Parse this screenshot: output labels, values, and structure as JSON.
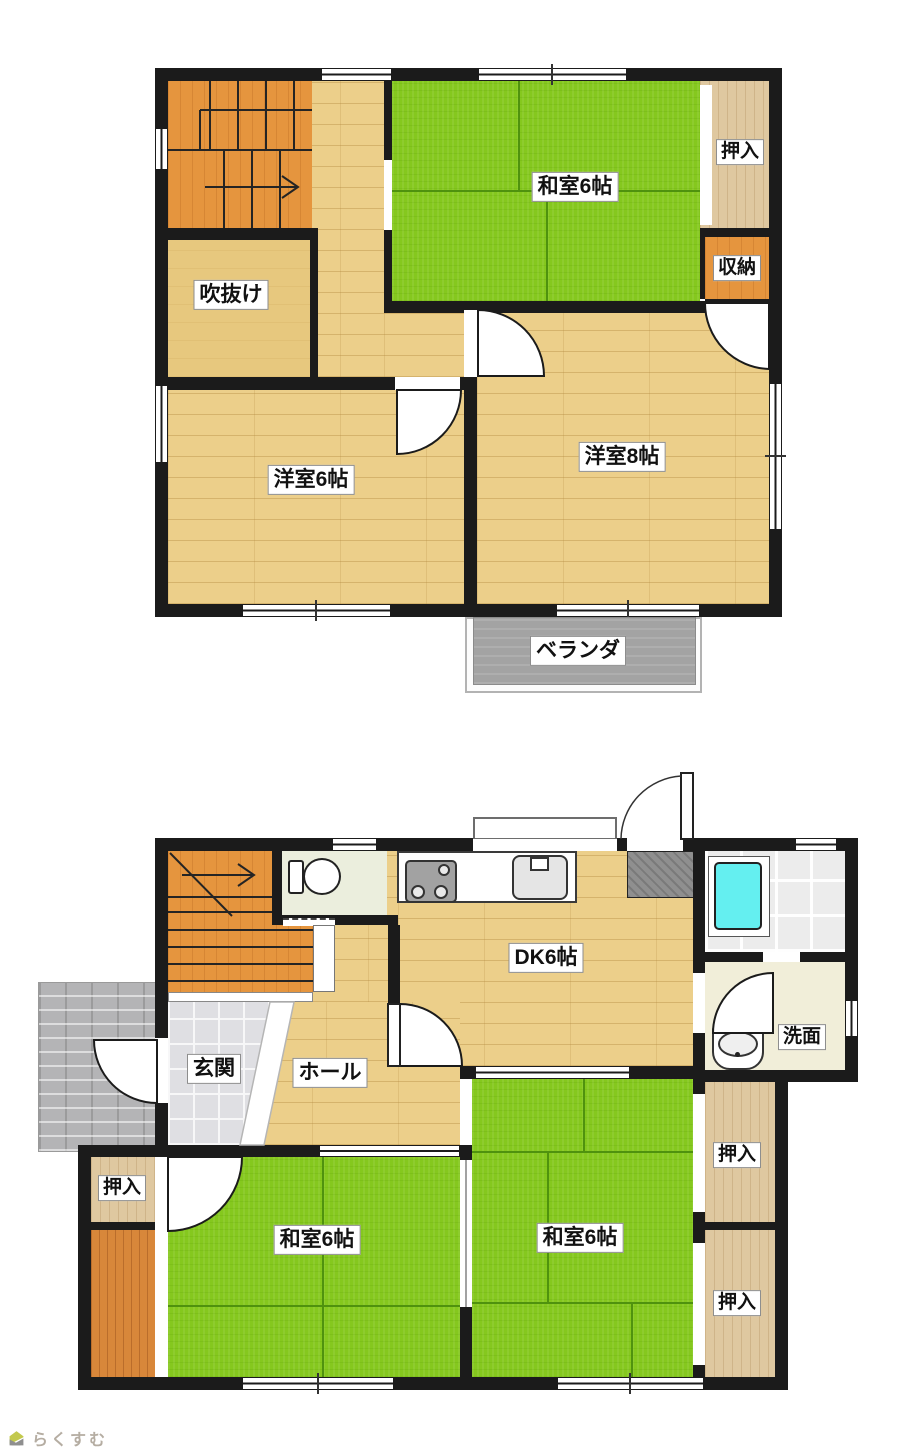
{
  "floor2": {
    "washitsu6": "和室6帖",
    "oshiire": "押入",
    "shuunou": "収納",
    "fukinuke": "吹抜け",
    "youshitsu6": "洋室6帖",
    "youshitsu8": "洋室8帖",
    "veranda": "ベランダ"
  },
  "floor1": {
    "dk": "DK6帖",
    "genkan": "玄関",
    "hall": "ホール",
    "senmen": "洗面",
    "washitsu_left": "和室6帖",
    "washitsu_right": "和室6帖",
    "oshiire_left": "押入",
    "oshiire_right_top": "押入",
    "oshiire_right_bottom": "押入"
  },
  "logo": {
    "text": "らくすむ"
  },
  "colors": {
    "wall": "#1b1b1b",
    "tatami_green": "#85c81e",
    "wood_floor": "#eccf8a",
    "stairs_orange": "#e5953e",
    "closet_wood": "#dfc8a0",
    "storage_orange": "#e5953e",
    "void_tan": "#e7c87e",
    "veranda_gray": "#a3a3a3",
    "bathtub_cyan": "#64eff0",
    "approach_gray": "#b4b4b6",
    "logo_text": "#b5ada2"
  }
}
